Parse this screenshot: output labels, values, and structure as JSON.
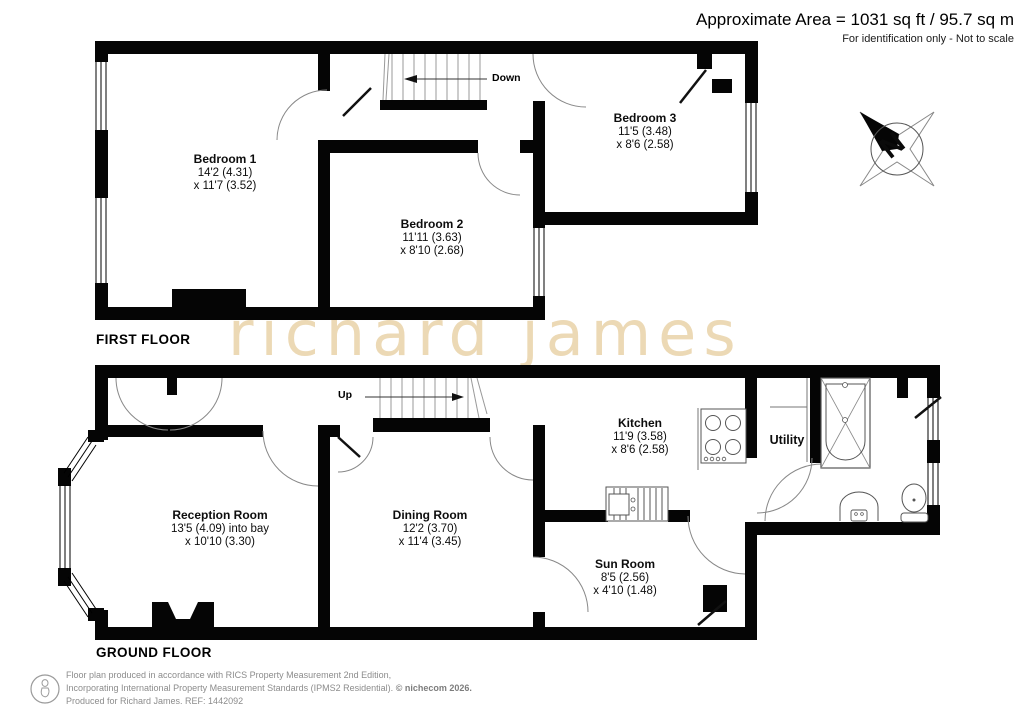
{
  "header": {
    "area_line": "Approximate Area = 1031 sq ft / 95.7 sq m",
    "disclaimer": "For identification only - Not to scale"
  },
  "floors": {
    "first": {
      "label": "FIRST FLOOR"
    },
    "ground": {
      "label": "GROUND FLOOR"
    }
  },
  "rooms": {
    "bedroom1": {
      "name": "Bedroom 1",
      "dim1": "14'2 (4.31)",
      "dim2": "x 11'7 (3.52)"
    },
    "bedroom2": {
      "name": "Bedroom 2",
      "dim1": "11'11 (3.63)",
      "dim2": "x 8'10 (2.68)"
    },
    "bedroom3": {
      "name": "Bedroom 3",
      "dim1": "11'5 (3.48)",
      "dim2": "x 8'6 (2.58)"
    },
    "reception": {
      "name": "Reception Room",
      "dim1": "13'5 (4.09) into bay",
      "dim2": "x 10'10 (3.30)"
    },
    "dining": {
      "name": "Dining Room",
      "dim1": "12'2 (3.70)",
      "dim2": "x 11'4 (3.45)"
    },
    "kitchen": {
      "name": "Kitchen",
      "dim1": "11'9 (3.58)",
      "dim2": "x 8'6 (2.58)"
    },
    "sunroom": {
      "name": "Sun Room",
      "dim1": "8'5 (2.56)",
      "dim2": "x 4'10 (1.48)"
    },
    "utility": {
      "name": "Utility"
    }
  },
  "stairs": {
    "up_label": "Up",
    "down_label": "Down"
  },
  "compass": {
    "north_label": "N"
  },
  "watermark": {
    "text": "richard james",
    "color": "#ecd9b5"
  },
  "colors": {
    "wall": "#050505",
    "watermark": "#ecd9b5",
    "door_arc": "#888888"
  },
  "footer": {
    "line1": "Floor plan produced in accordance with RICS Property Measurement 2nd Edition,",
    "line2": "Incorporating International Property Measurement Standards (IPMS2 Residential).",
    "copyright": "© nichecom 2026.",
    "line3": "Produced for Richard James.   REF:  1442092"
  }
}
